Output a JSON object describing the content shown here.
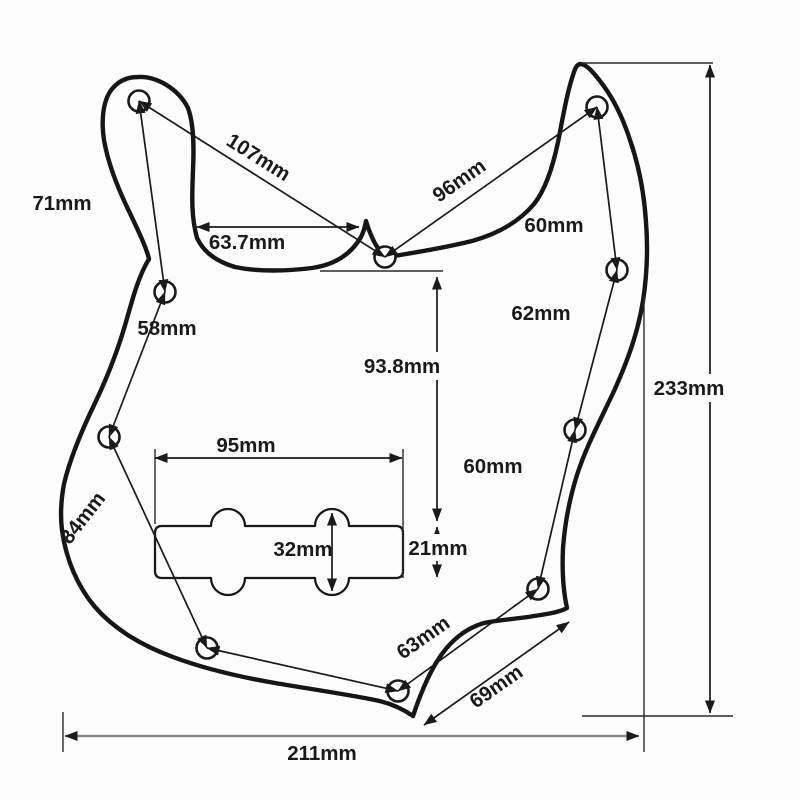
{
  "figure": {
    "type": "technical-dimension-drawing",
    "subject": "jazz-bass-pickguard",
    "unit": "mm"
  },
  "colors": {
    "ink": "#1a1a1a",
    "baseline_gray": "#8a8a8a",
    "background": "#fdfdfd"
  },
  "dimensions": {
    "dim_107": "107mm",
    "dim_96": "96mm",
    "dim_71": "71mm",
    "dim_63_7": "63.7mm",
    "dim_58": "58mm",
    "dim_60_upper": "60mm",
    "dim_62": "62mm",
    "dim_93_8": "93.8mm",
    "dim_233": "233mm",
    "dim_95": "95mm",
    "dim_60_lower": "60mm",
    "dim_84": "84mm",
    "dim_32": "32mm",
    "dim_21": "21mm",
    "dim_63": "63mm",
    "dim_69": "69mm",
    "dim_211": "211mm"
  }
}
